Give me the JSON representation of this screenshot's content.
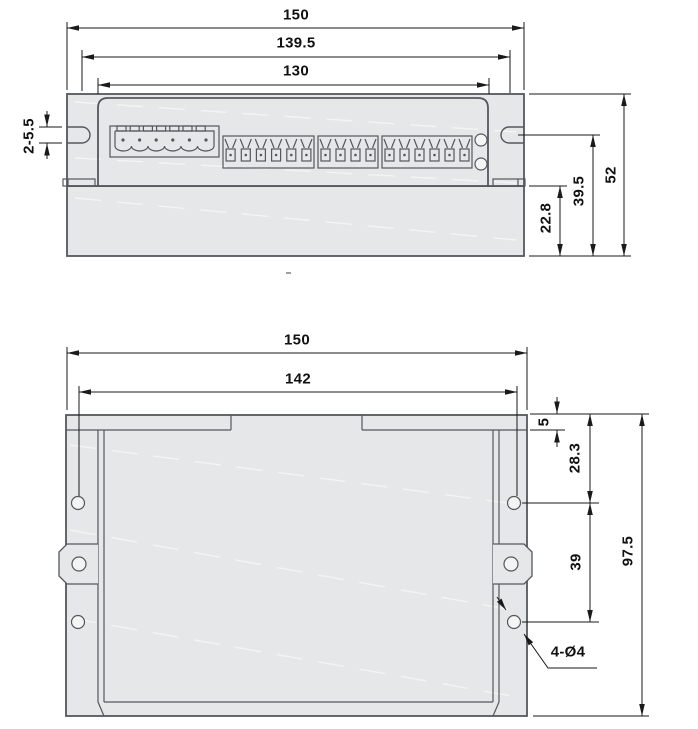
{
  "front_view": {
    "dim_overall_width": "150",
    "dim_mounting_width": "139.5",
    "dim_panel_width": "130",
    "dim_slot_callout": "2-5.5",
    "dim_overall_height": "52",
    "dim_slot_center_height": "39.5",
    "dim_base_height": "22.8",
    "connector": {
      "pins": 6,
      "top_tabs": 7
    },
    "terminal_groups": [
      6,
      4,
      6
    ],
    "led_count": 2
  },
  "plan_view": {
    "dim_overall_width": "150",
    "dim_hole_span_width": "142",
    "dim_top_inset": "5",
    "dim_hole_top_offset": "28.3",
    "dim_hole_pitch": "39",
    "dim_overall_height": "97.5",
    "hole_callout": "4-Ø4",
    "side_hole_rows": 3
  },
  "colors": {
    "background": "#ffffff",
    "body_fill": "#e6e7e8",
    "outline": "#54585c",
    "dimension": "#1a1a1a"
  }
}
